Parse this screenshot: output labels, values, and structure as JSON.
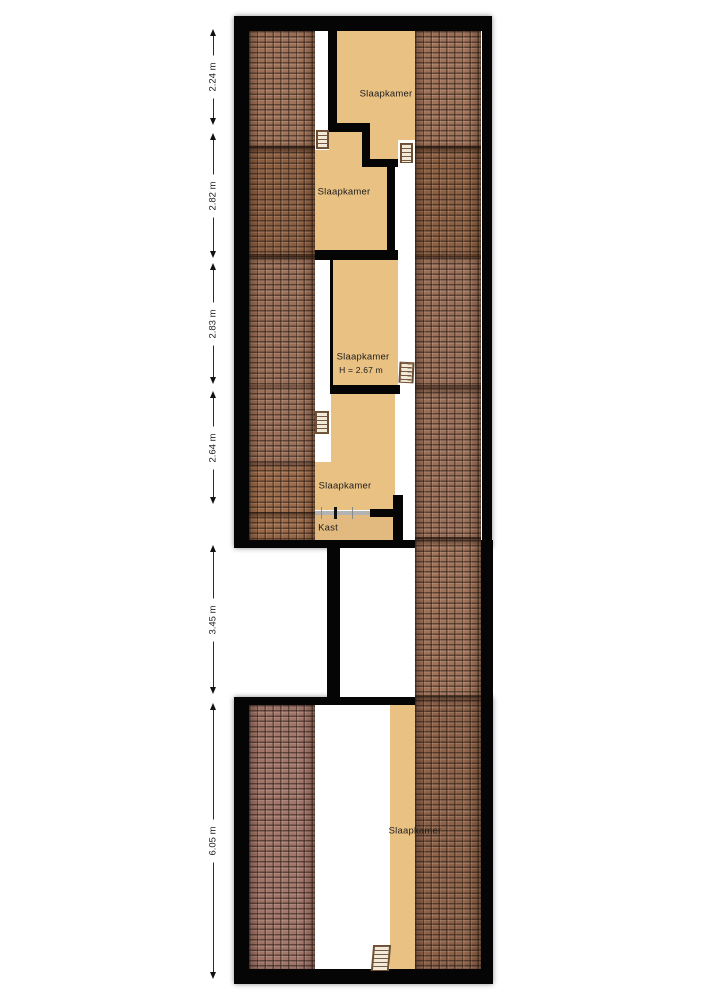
{
  "plan": {
    "type": "floorplan-attic-level"
  },
  "rooms": [
    {
      "label": "Slaapkamer"
    },
    {
      "label": "Slaapkamer"
    },
    {
      "label": "Slaapkamer",
      "height_note": "H = 2.67 m"
    },
    {
      "label": "Slaapkamer"
    },
    {
      "label": "Kast"
    },
    {
      "label": "Slaapkamer"
    }
  ],
  "dimensions": [
    {
      "label": "2.24 m"
    },
    {
      "label": "2.82 m"
    },
    {
      "label": "2.83 m"
    },
    {
      "label": "2.64 m"
    },
    {
      "label": "3.45 m"
    },
    {
      "label": "6.05 m"
    }
  ],
  "icons": {
    "stairs": "stairs-icon",
    "stairs_count": 5
  },
  "colors": {
    "wall": "#050505",
    "room": "#e9c183",
    "room_muted": "#e2ba80",
    "roof_1": "#a07258",
    "roof_2": "#8d5f41",
    "roof_3": "#9c7058",
    "roof_4": "#9d6b49",
    "roof_5": "#a3766a",
    "roof_6": "#8f6248",
    "slider": "#b3b3b3"
  }
}
